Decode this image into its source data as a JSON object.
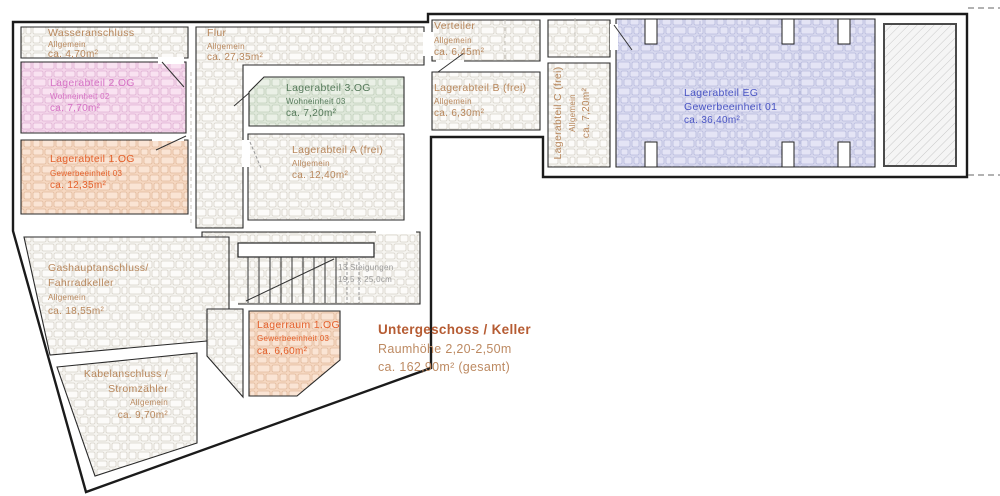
{
  "title_block": {
    "line1": "Untergeschoss / Keller",
    "line2": "Raumhöhe 2,20-2,50m",
    "line3": "ca. 162,90m² (gesamt)"
  },
  "stairs": {
    "risers": "13 Steigungen",
    "dimensions": "19,5 x 25,0cm"
  },
  "rooms": [
    {
      "id": "wasseranschluss",
      "name": "Wasseranschluss",
      "unit": "Allgemein",
      "area": "ca. 4,70m²",
      "tint": "none"
    },
    {
      "id": "lagerabteil-2og",
      "name": "Lagerabteil 2.OG",
      "unit": "Wohneinheit 02",
      "area": "ca. 7,70m²",
      "tint": "#f4d6ea"
    },
    {
      "id": "lagerabteil-1og",
      "name": "Lagerabteil 1.OG",
      "unit": "Gewerbeeinheit 03",
      "area": "ca. 12,35m²",
      "tint": "#f6d8c2"
    },
    {
      "id": "flur",
      "name": "Flur",
      "unit": "Allgemein",
      "area": "ca. 27,35m²",
      "tint": "none"
    },
    {
      "id": "lagerabteil-3og",
      "name": "Lagerabteil 3.OG",
      "unit": "Wohneinheit 03",
      "area": "ca. 7,20m²",
      "tint": "#dfe8da"
    },
    {
      "id": "lagerabteil-a",
      "name": "Lagerabteil A (frei)",
      "unit": "Allgemein",
      "area": "ca. 12,40m²",
      "tint": "none"
    },
    {
      "id": "verteiler",
      "name": "Verteiler",
      "unit": "Allgemein",
      "area": "ca. 6,45m²",
      "tint": "none"
    },
    {
      "id": "lagerabteil-b",
      "name": "Lagerabteil B (frei)",
      "unit": "Allgemein",
      "area": "ca. 6,30m²",
      "tint": "none"
    },
    {
      "id": "lagerabteil-c",
      "name": "Lagerabteil C (frei)",
      "unit": "Allgemein",
      "area": "ca. 7,20m²",
      "tint": "none"
    },
    {
      "id": "lagerabteil-eg",
      "name": "Lagerabteil EG",
      "unit": "Gewerbeeinheit 01",
      "area": "ca. 36,40m²",
      "tint": "#d8d9ef"
    },
    {
      "id": "gashauptanschluss",
      "name": "Gashauptanschluss/",
      "name2": "Fahrradkeller",
      "unit": "Allgemein",
      "area": "ca. 18,55m²",
      "tint": "none"
    },
    {
      "id": "kabelanschluss",
      "name": "Kabelanschluss /",
      "name2": "Stromzähler",
      "unit": "Allgemein",
      "area": "ca. 9,70m²",
      "tint": "none"
    },
    {
      "id": "lagerraum-1og",
      "name": "Lagerraum 1.OG",
      "unit": "Gewerbeeinheit 03",
      "area": "ca. 6,60m²",
      "tint": "#f6d8c2"
    }
  ],
  "colors": {
    "plain_text": "#b8875c",
    "pink_text": "#d672c5",
    "orange_text": "#e4602b",
    "green_text": "#567a5b",
    "blue_text": "#4a55c4",
    "title_heading": "#b65c33",
    "stair_text": "#9a9a9a",
    "pink_fill": "#f4d6ea",
    "orange_fill": "#f6d8c2",
    "green_fill": "#dfe8da",
    "blue_fill": "#d8d9ef",
    "wall_line": "#1b1b1b"
  }
}
